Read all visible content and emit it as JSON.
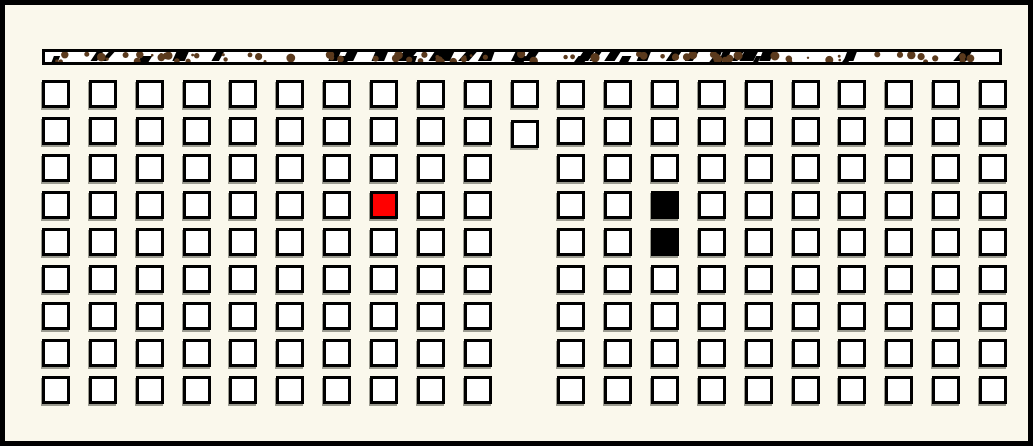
{
  "scene": {
    "background_color": "#faf8ec",
    "frame_color": "#000000"
  },
  "speckle_bar": {
    "fill_color": "#ffffff",
    "border_color": "#000000",
    "slash_color": "#000000",
    "speck_color": "#5b3a1d",
    "slash_count": 46,
    "speck_count": 80,
    "seed": 11
  },
  "grid": {
    "columns": 21,
    "rows": 9,
    "cell_fill": "#ffffff",
    "cell_border_color": "#000000",
    "cell_shadow_color": "#9b9b90",
    "missing_cells": [
      {
        "col": 10,
        "row": 2
      },
      {
        "col": 10,
        "row": 3
      },
      {
        "col": 10,
        "row": 4
      },
      {
        "col": 10,
        "row": 5
      },
      {
        "col": 10,
        "row": 6
      },
      {
        "col": 10,
        "row": 7
      },
      {
        "col": 10,
        "row": 8
      }
    ],
    "offset_cells": [
      {
        "col": 10,
        "row": 1,
        "dx": 0,
        "dy": 3
      }
    ],
    "colored_cells": [
      {
        "col": 7,
        "row": 3,
        "color": "#ff0000",
        "name": "red-cell"
      },
      {
        "col": 13,
        "row": 3,
        "color": "#000000",
        "name": "black-cell-upper"
      },
      {
        "col": 13,
        "row": 4,
        "color": "#000000",
        "name": "black-cell-lower"
      }
    ]
  }
}
